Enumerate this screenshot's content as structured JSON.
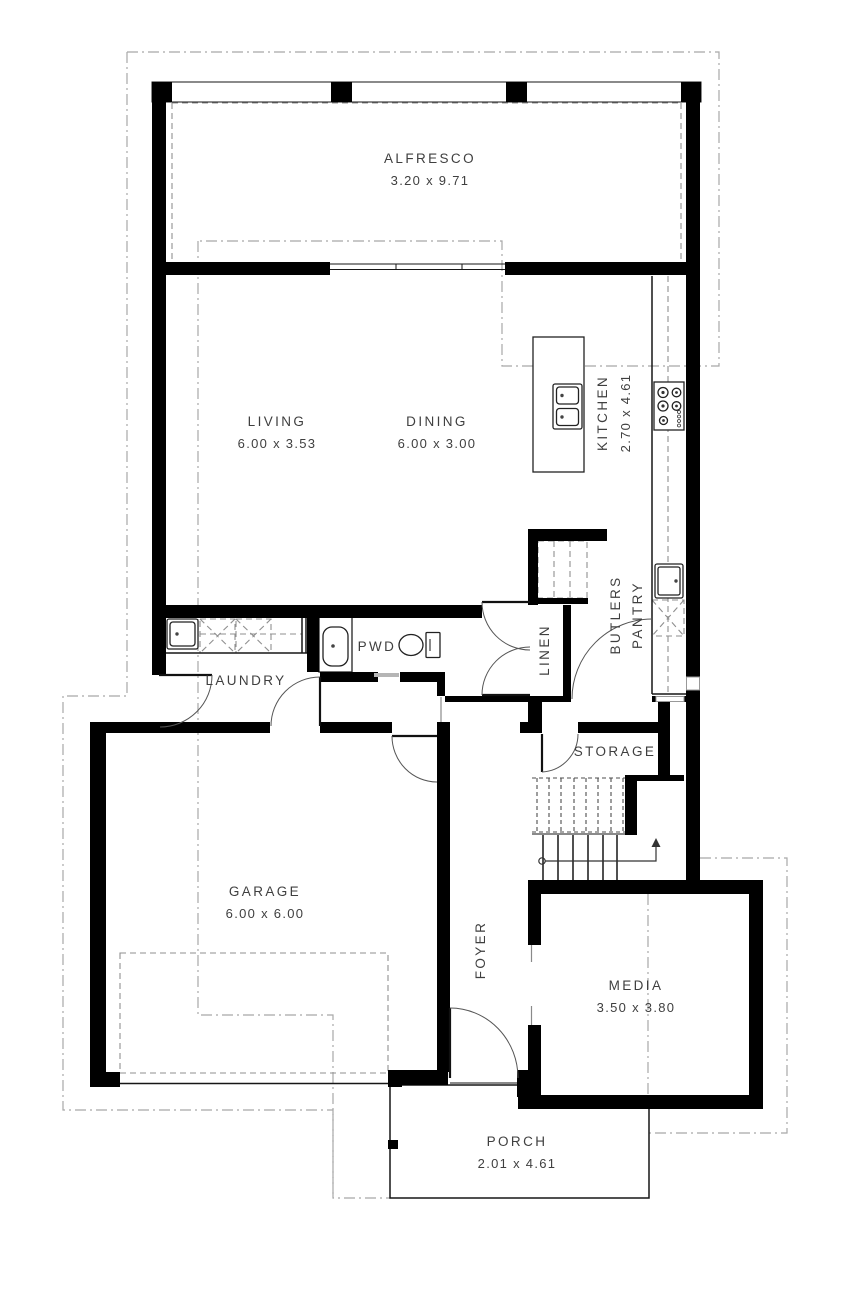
{
  "rooms": {
    "alfresco": {
      "name": "ALFRESCO",
      "dims": "3.20 x 9.71"
    },
    "living": {
      "name": "LIVING",
      "dims": "6.00 x 3.53"
    },
    "dining": {
      "name": "DINING",
      "dims": "6.00 x 3.00"
    },
    "kitchen": {
      "name": "KITCHEN",
      "dims": "2.70 x 4.61"
    },
    "butlers_pantry": {
      "line1": "BUTLERS",
      "line2": "PANTRY"
    },
    "linen": {
      "name": "LINEN"
    },
    "pwd": {
      "name": "PWD"
    },
    "laundry": {
      "name": "LAUNDRY"
    },
    "storage": {
      "name": "STORAGE"
    },
    "garage": {
      "name": "GARAGE",
      "dims": "6.00 x 6.00"
    },
    "foyer": {
      "name": "FOYER"
    },
    "media": {
      "name": "MEDIA",
      "dims": "3.50 x 3.80"
    },
    "porch": {
      "name": "PORCH",
      "dims": "2.01 x 4.61"
    }
  },
  "icons": {
    "stair_direction": "up-arrow"
  },
  "colors": {
    "wall": "#000000",
    "text": "#3f3f3f",
    "boundary": "#a8a8a8",
    "fixture_outline": "#222222"
  }
}
